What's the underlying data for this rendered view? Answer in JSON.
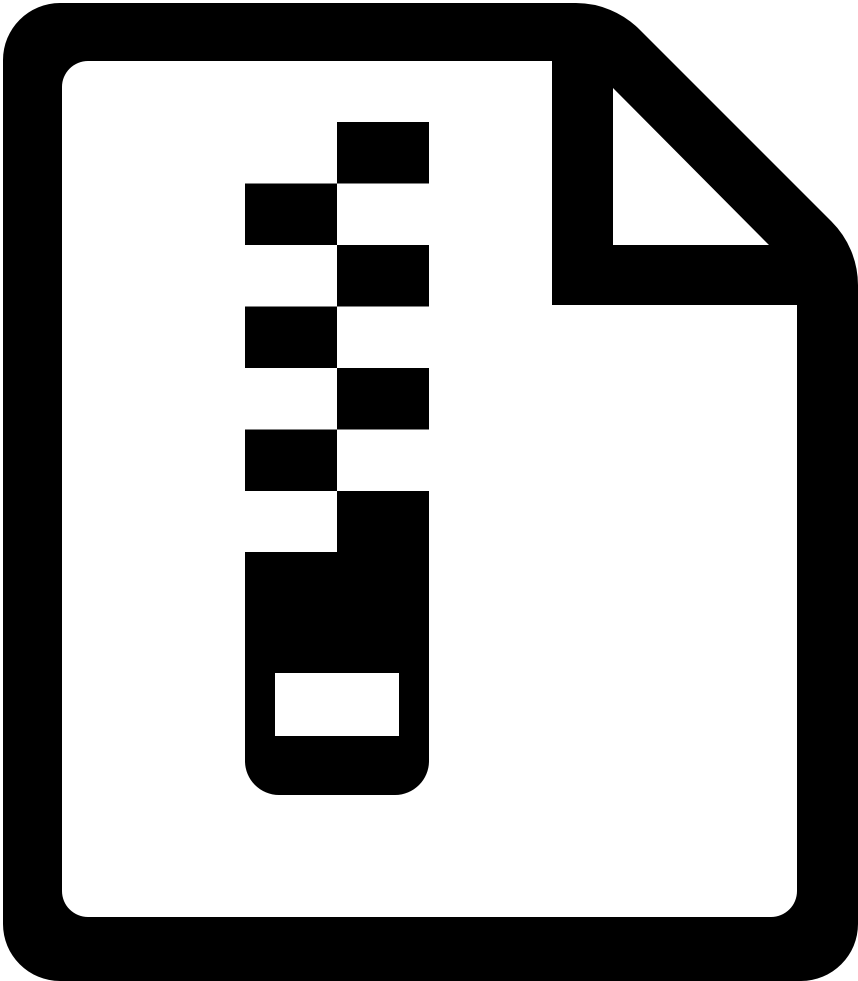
{
  "icon": {
    "name": "zip-file-icon",
    "description": "Black zip / compressed archive file icon: document sheet with folded top-right corner and a vertical zipper of alternating teeth ending in a zipper pull with a hole",
    "glyph_color": "#000000",
    "background_color": "#ffffff"
  }
}
